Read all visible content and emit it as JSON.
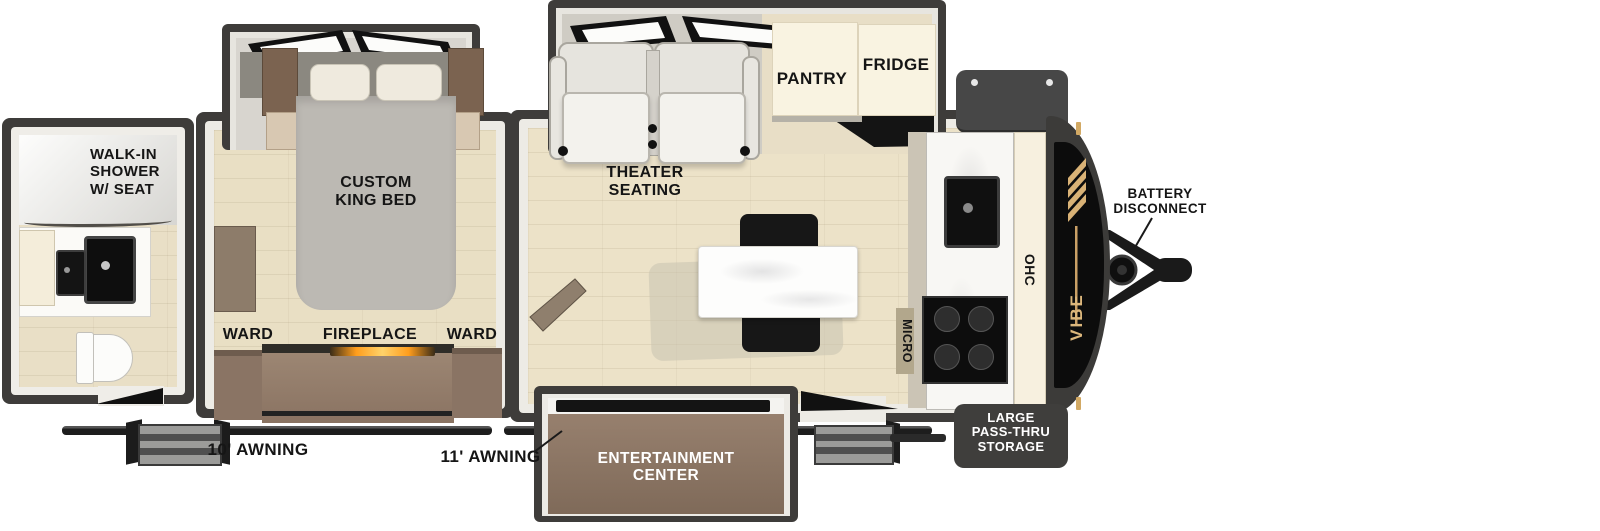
{
  "title": "Vibe travel trailer floorplan",
  "bathroom": {
    "shower_label": "WALK-IN\nSHOWER\nW/ SEAT"
  },
  "bedroom": {
    "bed_label": "CUSTOM\nKING BED",
    "ward_left": "WARD",
    "fireplace": "FIREPLACE",
    "ward_right": "WARD"
  },
  "living": {
    "theater_seating": "THEATER\nSEATING",
    "pantry": "PANTRY",
    "fridge": "FRIDGE",
    "micro": "MICRO",
    "ohc": "OHC"
  },
  "exterior": {
    "entertainment_center": "ENTERTAINMENT\nCENTER",
    "awning_rear": "10' AWNING",
    "awning_main": "11' AWNING",
    "battery_disconnect": "BATTERY\nDISCONNECT",
    "pass_thru_storage": "LARGE\nPASS-THRU\nSTORAGE",
    "brand": "VIBE"
  },
  "colors": {
    "wall": "#3e3c3a",
    "wood_floor": "#e9dfc6",
    "cabinet_brown": "#8d7665",
    "cabinet_cream": "#f8f2e1",
    "appliance_black": "#141414",
    "brand_gold": "#dcb77c",
    "fireplace_glow": "#ff9d1c",
    "badge_bg": "#3f3e3c",
    "label_text": "#151515"
  }
}
